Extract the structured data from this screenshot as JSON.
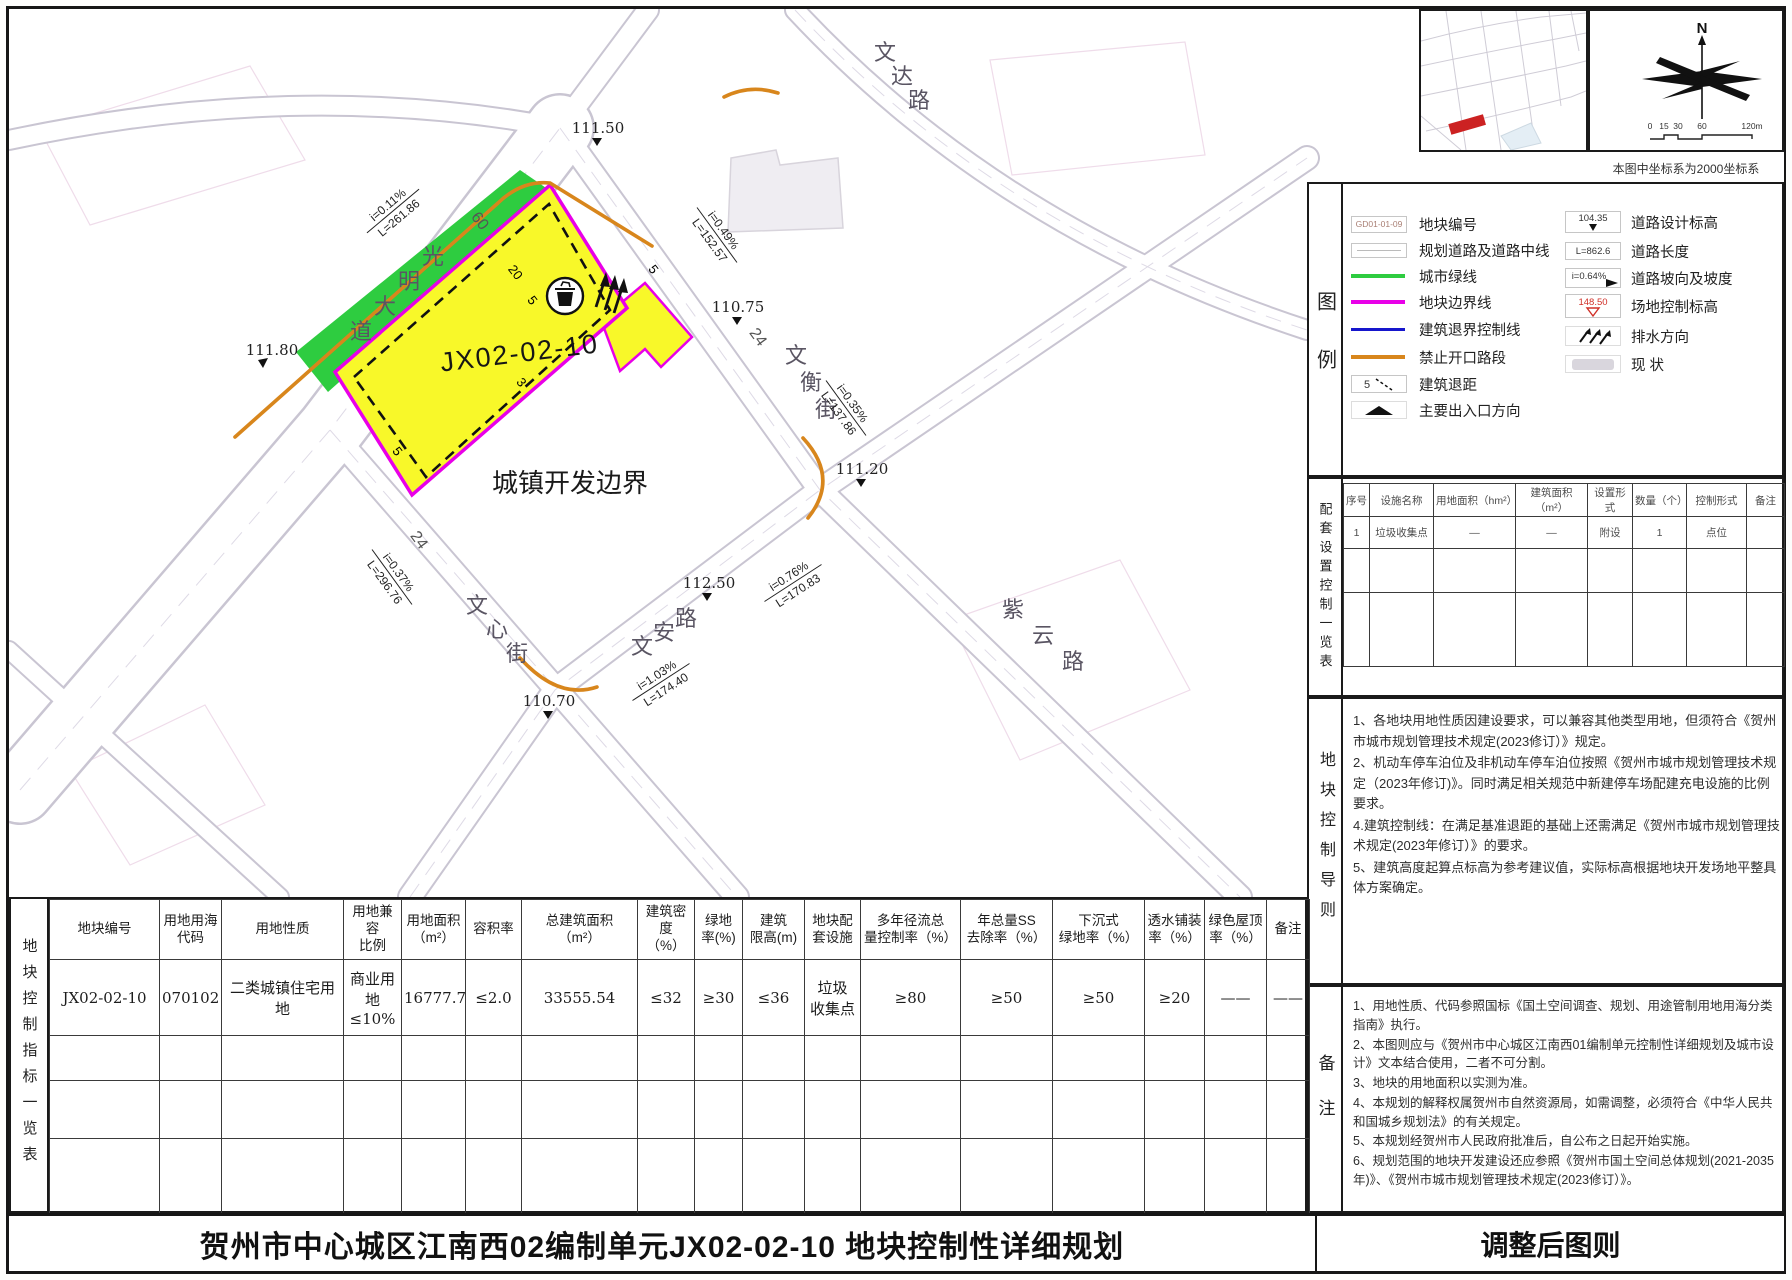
{
  "titles": {
    "main": "贺州市中心城区江南西02编制单元JX02-02-10 地块控制性详细规划",
    "side": "调整后图则",
    "coord_note": "本图中坐标系为2000坐标系"
  },
  "colors": {
    "parcel_yellow": "#f8f829",
    "green_line": "#2ecc40",
    "parcel_boundary_magenta": "#e800e8",
    "setback_blue": "#1616cc",
    "no_opening_orange": "#d8861c",
    "site_elev_red": "#d03028"
  },
  "map": {
    "parcel_code": "JX02-02-10",
    "boundary_label": "城镇开发边界",
    "road_names": [
      "光明大道",
      "文达路",
      "文衡街",
      "文心街",
      "文安路",
      "紫云路"
    ],
    "width_labels": [
      "60",
      "24",
      "24"
    ],
    "setbacks": [
      "20",
      "5",
      "5",
      "3",
      "5"
    ],
    "elevations": [
      "111.50",
      "111.80",
      "110.75",
      "111.20",
      "112.50",
      "110.70"
    ],
    "slopes": [
      {
        "i": "i=0.11%",
        "L": "L=261.86"
      },
      {
        "i": "i=0.49%",
        "L": "L=152.57"
      },
      {
        "i": "i=0.35%",
        "L": "L=137.86"
      },
      {
        "i": "i=0.37%",
        "L": "L=296.76"
      },
      {
        "i": "i=1.03%",
        "L": "L=174.40"
      },
      {
        "i": "i=0.76%",
        "L": "L=170.83"
      }
    ]
  },
  "legend": {
    "title": "图例",
    "left": [
      {
        "label": "地块编号",
        "sample": "GD01-01-09"
      },
      {
        "label": "规划道路及道路中线"
      },
      {
        "label": "城市绿线"
      },
      {
        "label": "地块边界线"
      },
      {
        "label": "建筑退界控制线"
      },
      {
        "label": "禁止开口路段"
      },
      {
        "label": "建筑退距",
        "sample": "5"
      },
      {
        "label": "主要出入口方向"
      }
    ],
    "right": [
      {
        "label": "道路设计标高",
        "sample": "104.35"
      },
      {
        "label": "道路长度",
        "sample": "L=862.6"
      },
      {
        "label": "道路坡向及坡度",
        "sample": "i=0.64%"
      },
      {
        "label": "场地控制标高",
        "sample": "148.50"
      },
      {
        "label": "排水方向"
      },
      {
        "label": "现  状"
      }
    ]
  },
  "facilities": {
    "title": "配套设置控制一览表",
    "headers": [
      "序号",
      "设施名称",
      "用地面积（hm²）",
      "建筑面积（m²）",
      "设置形式",
      "数量（个）",
      "控制形式",
      "备注"
    ],
    "row": [
      "1",
      "垃圾收集点",
      "—",
      "—",
      "附设",
      "1",
      "点位",
      ""
    ]
  },
  "guideline": {
    "title": "地块控制导则",
    "items": [
      "1、各地块用地性质因建设要求，可以兼容其他类型用地，但须符合《贺州市城市规划管理技术规定(2023修订）》规定。",
      "2、机动车停车泊位及非机动车停车泊位按照《贺州市城市规划管理技术规定（2023年修订)》。同时满足相关规范中新建停车场配建充电设施的比例要求。",
      "4.建筑控制线：在满足基准退距的基础上还需满足《贺州市城市规划管理技术规定(2023年修订）》的要求。",
      "5、建筑高度起算点标高为参考建议值，实际标高根据地块开发场地平整具体方案确定。"
    ]
  },
  "remarks": {
    "title": "备注",
    "items": [
      "1、用地性质、代码参照国标《国土空间调查、规划、用途管制用地用海分类指南》执行。",
      "2、本图则应与《贺州市中心城区江南西01编制单元控制性详细规划及城市设计》文本结合使用，二者不可分割。",
      "3、地块的用地面积以实测为准。",
      "4、本规划的解释权属贺州市自然资源局，如需调整，必须符合《中华人民共和国城乡规划法》的有关规定。",
      "5、本规划经贺州市人民政府批准后，自公布之日起开始实施。",
      "6、规划范围的地块开发建设还应参照《贺州市国土空间总体规划(2021-2035年)》、《贺州市城市规划管理技术规定(2023修订）》。"
    ]
  },
  "indicator_table": {
    "title": "地块控制指标一览表",
    "headers": [
      "地块编号",
      "用地用海\n代码",
      "用地性质",
      "用地兼容\n比例",
      "用地面积\n（m²）",
      "容积率",
      "总建筑面积\n（m²）",
      "建筑密度\n（%）",
      "绿地\n率(%)",
      "建筑\n限高(m)",
      "地块配\n套设施",
      "多年径流总\n量控制率（%）",
      "年总量SS\n去除率（%）",
      "下沉式\n绿地率（%）",
      "透水铺装\n率（%）",
      "绿色屋顶\n率（%）",
      "备注"
    ],
    "row": [
      "JX02-02-10",
      "070102",
      "二类城镇住宅用地",
      "商业用地\n≤10%",
      "16777.77",
      "≤2.0",
      "33555.54",
      "≤32",
      "≥30",
      "≤36",
      "垃圾\n收集点",
      "≥80",
      "≥50",
      "≥50",
      "≥20",
      "——",
      "——"
    ]
  },
  "compass": {
    "north": "N",
    "ticks": [
      "0",
      "15",
      "30",
      "60",
      "120m"
    ]
  }
}
